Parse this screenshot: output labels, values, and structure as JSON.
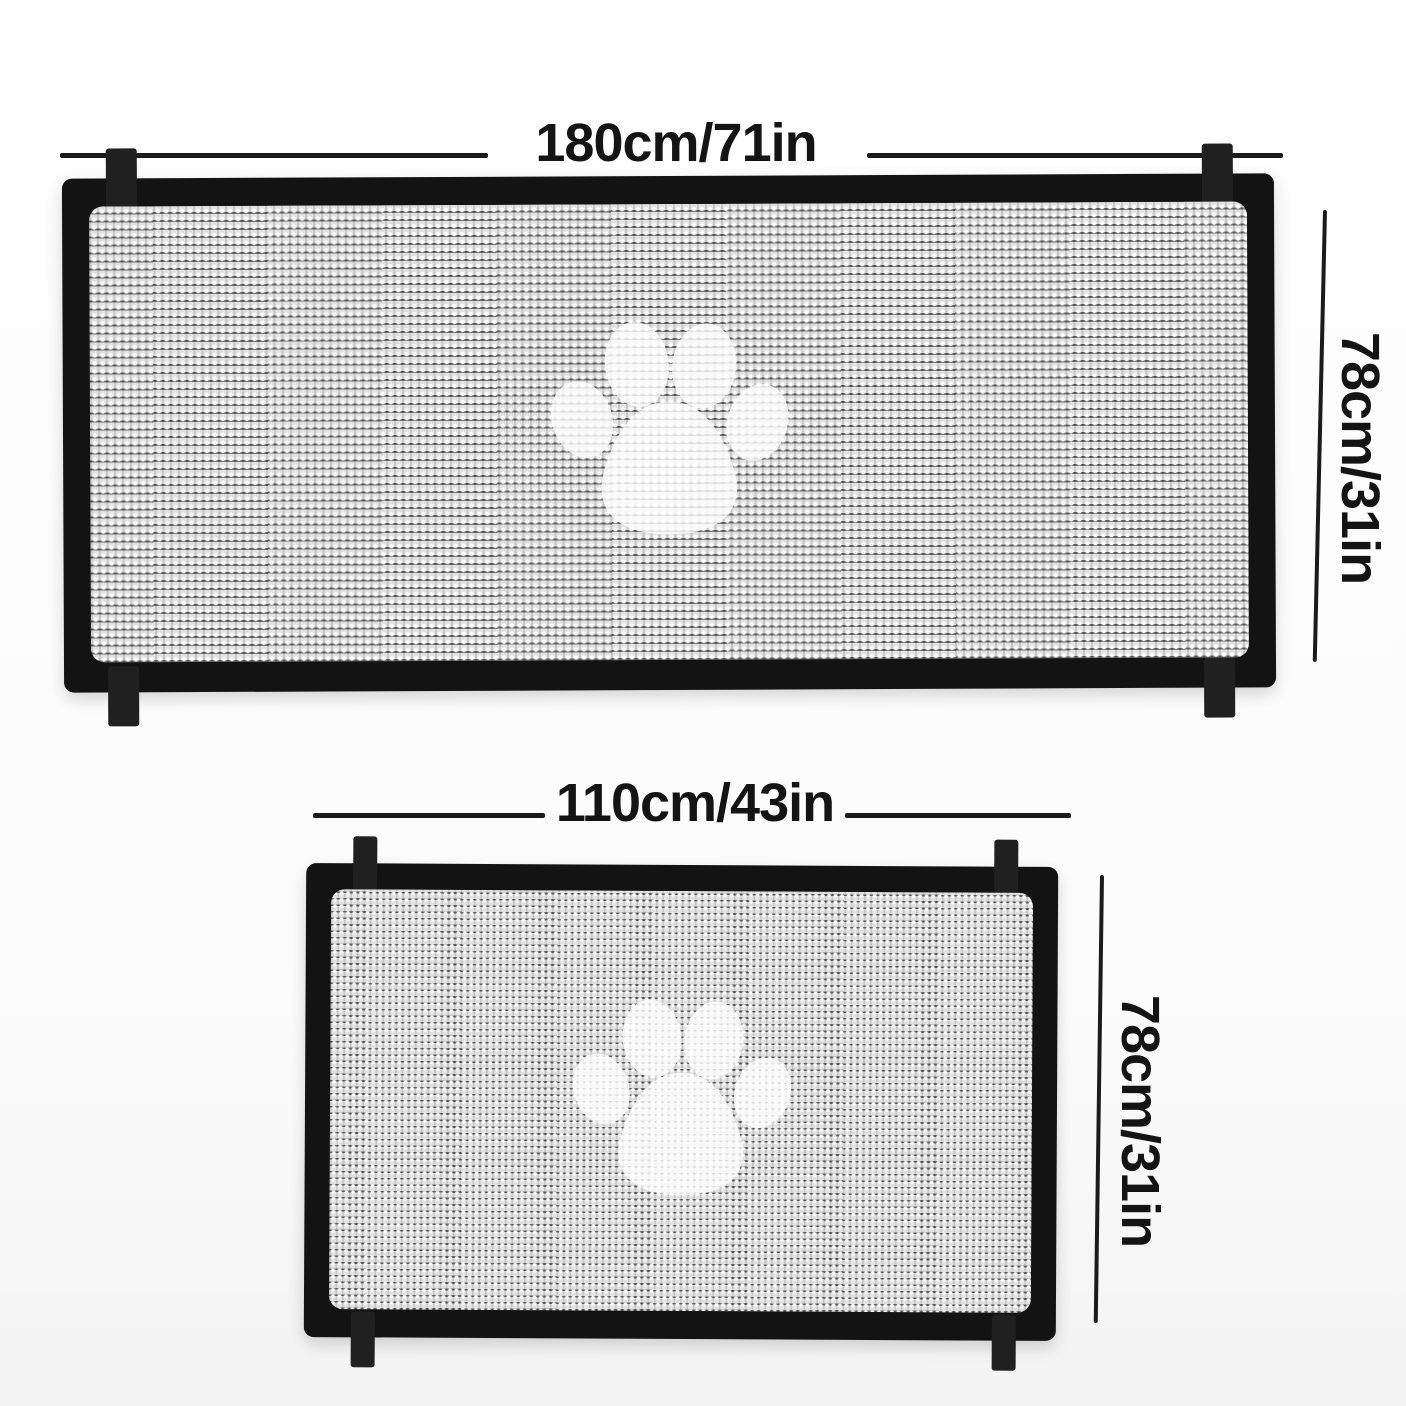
{
  "product_diagram": {
    "description": "Size diagram of a mesh pet safety gate shown in two sizes, each with a white paw print on woven mesh and mounting tabs at the corners",
    "colors": {
      "frame": "#131313",
      "mesh": "#c9c9c9",
      "paw": "#ffffff",
      "dimension_text": "#141414",
      "background": "#fcfcfc"
    },
    "panels": [
      {
        "name": "large-gate",
        "width_label": "180cm/71in",
        "height_label": "78cm/31in"
      },
      {
        "name": "small-gate",
        "width_label": "110cm/43in",
        "height_label": "78cm/31in"
      }
    ],
    "icon": "paw-print"
  }
}
